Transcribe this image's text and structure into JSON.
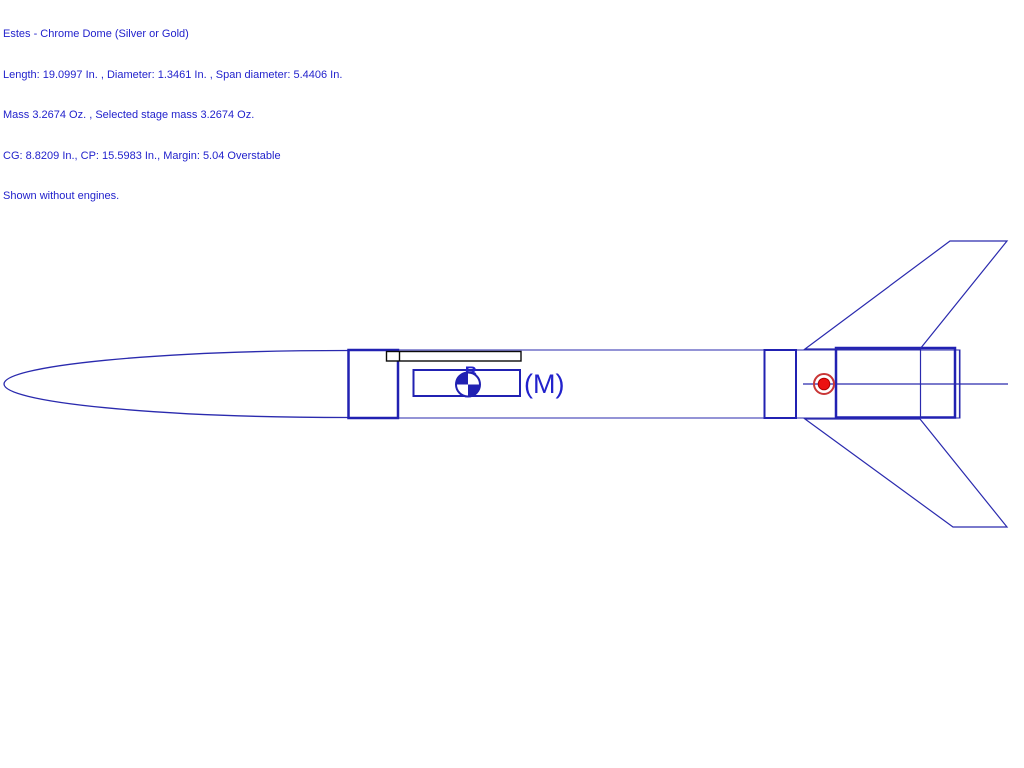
{
  "header": {
    "lines": [
      "Estes - Chrome Dome (Silver or Gold)",
      "Length: 19.0997 In. , Diameter: 1.3461 In. , Span diameter: 5.4406 In.",
      "Mass 3.2674 Oz. , Selected stage mass 3.2674 Oz.",
      "CG: 8.8209 In., CP: 15.5983 In., Margin: 5.04 Overstable",
      "Shown without engines."
    ]
  },
  "diagram": {
    "cg_marker_label": "B",
    "mass_override_label": "(M)",
    "rocket_name": "Estes - Chrome Dome (Silver or Gold)",
    "cg_value_in": "8.8209",
    "cp_value_in": "15.5983",
    "margin": "5.04 Overstable"
  },
  "colors": {
    "canvas_bg": "#ffffff",
    "text_blue": "#2222cc",
    "line_blue": "#2a2aae",
    "thick_blue": "#2121b2",
    "lug_black": "#0a0a0a",
    "cp_ring_red": "#c93636",
    "cp_dot_red": "#ec1111",
    "cp_dot_edge": "#b00000"
  }
}
